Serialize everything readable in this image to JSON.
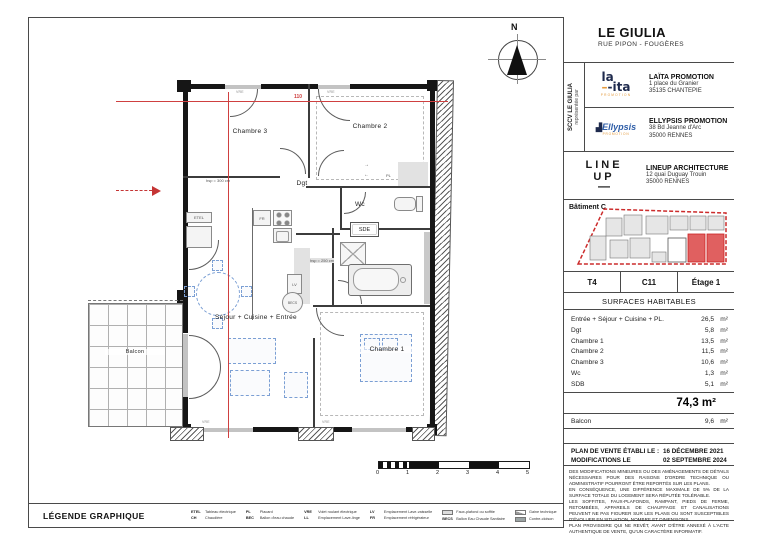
{
  "title_block": {
    "project": "LE GIULIA",
    "project_address": "RUE PIPON - FOUGÈRES",
    "sccv_line1": "SCCV LE GIULIA",
    "sccv_line2": "représentée par",
    "promoters": [
      {
        "logo_main": "la",
        "logo_second": "-ita",
        "logo_sub": "PROMOTION",
        "name": "LAÏTA PROMOTION",
        "addr1": "1 place du Granier",
        "addr2": "35135 CHANTEPIE"
      },
      {
        "logo_main": "Ellypsis",
        "logo_sub": "PROMOTION",
        "name": "ELLYPSIS PROMOTION",
        "addr1": "38 Bd Jeanne d'Arc",
        "addr2": "35000 RENNES"
      }
    ],
    "architect": {
      "logo1": "LINE",
      "logo2": "UP",
      "logo3": "—",
      "name": "LINEUP ARCHITECTURE",
      "addr1": "12 quai Duguay Trouin",
      "addr2": "35000 RENNES"
    },
    "batiment": "Bâtiment C",
    "unit_type": "T4",
    "unit_number": "C11",
    "unit_floor": "Étage 1",
    "surfaces_title": "SURFACES HABITABLES",
    "sqm": "m²",
    "surfaces": [
      {
        "label": "Entrée + Séjour + Cuisine + PL.",
        "value": "26,5"
      },
      {
        "label": "Dgt",
        "value": "5,8"
      },
      {
        "label": "Chambre 1",
        "value": "13,5"
      },
      {
        "label": "Chambre 2",
        "value": "11,5"
      },
      {
        "label": "Chambre 3",
        "value": "10,6"
      },
      {
        "label": "Wc",
        "value": "1,3"
      },
      {
        "label": "SDB",
        "value": "5,1"
      }
    ],
    "total": "74,3 m²",
    "balcon_label": "Balcon",
    "balcon_value": "9,6",
    "date_label1": "PLAN DE VENTE ÉTABLI LE :",
    "date_value1": "16 DÉCEMBRE 2021",
    "date_label2": "MODIFICATIONS LE",
    "date_value2": "02 SEPTEMBRE 2024",
    "disclaimer": [
      "DES MODIFICATIONS MINEURES OU DES AMÉNAGEMENTS DE DÉTAILS NÉCESSAIRES POUR DES RAISONS D'ORDRE TECHNIQUE OU ADMINISTRATIF POURRONT ÊTRE REPORTÉS SUR LES PLANS.",
      "EN CONSÉQUENCE, UNE DIFFÉRENCE MAXIMALE DE 5% DE LA SURFACE TOTALE DU LOGEMENT SERA RÉPUTÉE TOLÉRABLE.",
      "LES SOFFITES, FAUX-PLAFONDS, RAMPANT, PIEDS DE FERME, RETOMBÉES, APPAREILS DE CHAUFFAGE ET CANALISATIONS PEUVENT NE PAS FIGURER SUR LES PLANS OU SONT SUSCEPTIBLES D'ÉVOLUER EN SITUATION, NOMBRE ET DIMENSIONS.",
      "PLAN PROVISOIRE QUI NE REVÊT, AVANT D'ÊTRE ANNEXÉ À L'ACTE AUTHENTIQUE DE VENTE, QU'UN CARACTÈRE INFORMATIF."
    ]
  },
  "plan": {
    "north": "N",
    "rooms": {
      "chambre3": "Chambre 3",
      "chambre2": "Chambre 2",
      "dgt": "Dgt",
      "wc": "Wc",
      "sde": "SDE",
      "sejour": "Séjour + Cuisine + Entrée",
      "chambre1": "Chambre 1",
      "balcon": "Balcon"
    },
    "ann": {
      "hsp300": "hsp = 300 cm",
      "hsp250": "hsp = 250 cm",
      "dim110": "110",
      "etel": "ETEL",
      "fr": "FR",
      "lv": "LV",
      "becs": "BECS",
      "pl": "PL",
      "vre": "VRE",
      "arrow_r": "→",
      "arrow_l": "←"
    },
    "scale_labels": [
      "0",
      "1",
      "2",
      "3",
      "4",
      "5"
    ]
  },
  "legend": {
    "title": "LÉGENDE GRAPHIQUE",
    "items": [
      {
        "abbr": "ETEL",
        "label": "Tableau électrique"
      },
      {
        "abbr": "CH",
        "label": "Chaudière"
      },
      {
        "abbr": "PL",
        "label": "Placard"
      },
      {
        "abbr": "BEC",
        "label": "Ballon d'eau chaude"
      },
      {
        "abbr": "VRE",
        "label": "Volet roulant électrique"
      },
      {
        "abbr": "LL",
        "label": "Emplacement Lave-linge"
      },
      {
        "abbr": "LV",
        "label": "Emplacement Lave-vaisselle"
      },
      {
        "abbr": "FR",
        "label": "Emplacement réfrigérateur"
      },
      {
        "abbr": "",
        "label": "Faux-plafond ou soffite"
      },
      {
        "abbr": "BECS",
        "label": "Ballon Eau Chaude Sanitaire"
      },
      {
        "abbr": "",
        "label": "Gaine technique"
      },
      {
        "abbr": "",
        "label": "Contre-cloison"
      }
    ]
  },
  "colors": {
    "wall": "#161616",
    "section_red": "#cf4040",
    "furniture_blue": "#7b9fd4",
    "laita_navy": "#1e2a4d",
    "logo_orange": "#e49a3c",
    "ellypsis_blue": "#2f5ea8",
    "mini_plan_red": "#cc2b2b"
  }
}
